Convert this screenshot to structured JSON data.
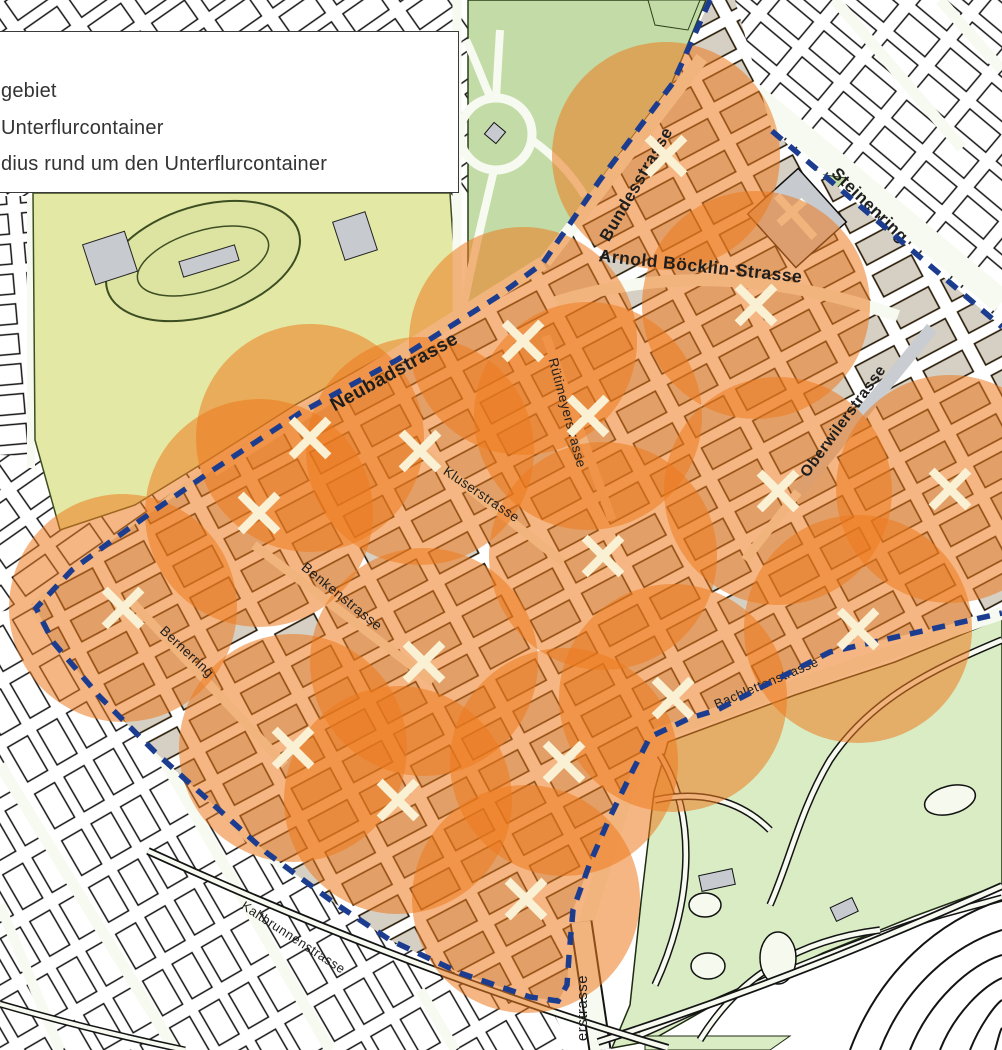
{
  "legend": {
    "rows": [
      "gebiet",
      "Unterflurcontainer",
      "dius rund um den Unterflurcontainer"
    ]
  },
  "streets": [
    {
      "name": "Bundesstrasse",
      "x": 641,
      "y": 187,
      "rot": -60,
      "size": 17
    },
    {
      "name": "Steinenring",
      "x": 866,
      "y": 209,
      "rot": 44,
      "size": 17
    },
    {
      "name": "Arnold Böcklin-Strasse",
      "x": 700,
      "y": 272,
      "rot": 6,
      "size": 17.5
    },
    {
      "name": "Neubadstrasse",
      "x": 397,
      "y": 377,
      "rot": -29,
      "size": 19
    },
    {
      "name": "Rütimeyerstrasse",
      "x": 563,
      "y": 414,
      "rot": 75,
      "size": 13.5
    },
    {
      "name": "Oberwilerstrasse",
      "x": 847,
      "y": 424,
      "rot": -54,
      "size": 15.5
    },
    {
      "name": "Kluserstrasse",
      "x": 479,
      "y": 498,
      "rot": 34,
      "size": 13.5
    },
    {
      "name": "Benkenstrasse",
      "x": 339,
      "y": 600,
      "rot": 39,
      "size": 14
    },
    {
      "name": "Bernerring",
      "x": 184,
      "y": 655,
      "rot": 43,
      "size": 13.5
    },
    {
      "name": "Bachlettenstrasse",
      "x": 768,
      "y": 687,
      "rot": -23,
      "size": 13
    },
    {
      "name": "Kaltbrunnenstrasse",
      "x": 291,
      "y": 941,
      "rot": 33,
      "size": 13
    },
    {
      "name": "erstrasse",
      "x": 587,
      "y": 1008,
      "rot": -90,
      "size": 15
    }
  ],
  "containers": {
    "radius_px": 114,
    "marks": [
      [
        666,
        156
      ],
      [
        756,
        305
      ],
      [
        523,
        341
      ],
      [
        588,
        416
      ],
      [
        778,
        491
      ],
      [
        950,
        489
      ],
      [
        310,
        438
      ],
      [
        420,
        451
      ],
      [
        259,
        513
      ],
      [
        123,
        608
      ],
      [
        603,
        556
      ],
      [
        424,
        662
      ],
      [
        673,
        698
      ],
      [
        858,
        629
      ],
      [
        564,
        762
      ],
      [
        293,
        748
      ],
      [
        398,
        800
      ],
      [
        526,
        899
      ]
    ]
  },
  "colors": {
    "radius_fill": "rgba(236,122,30,0.55)",
    "boundary": "#1c3d8f",
    "x_mark": "#faf1d4",
    "street_label": "#1e1e1e",
    "legend_text": "#333333",
    "park_top": "#c3dba6",
    "park_bottom": "#d9ecc4",
    "field": "#e4e8a5",
    "grey_building": "#c7cbd0",
    "block_building": "#d6cfc3",
    "path_white": "#f7faf0",
    "line_black": "#141414"
  }
}
